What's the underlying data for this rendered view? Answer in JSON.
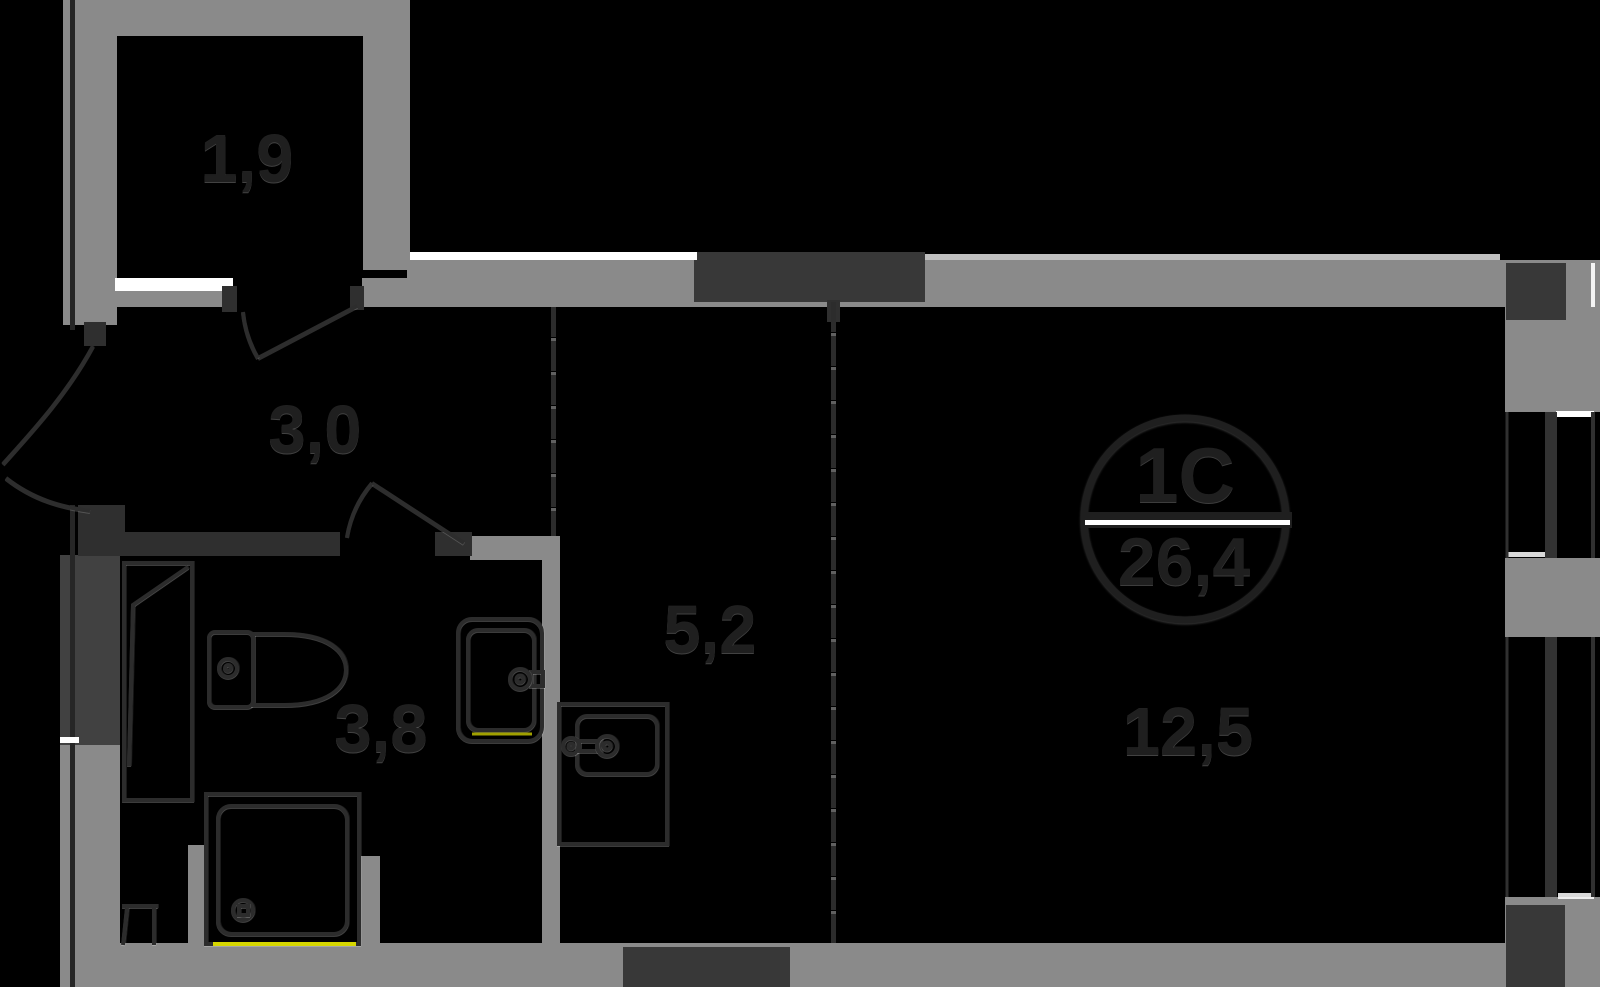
{
  "plan": {
    "unit": {
      "type_label": "1С",
      "area_label": "26,4"
    },
    "rooms": [
      {
        "id": "balcony",
        "area_label": "1,9"
      },
      {
        "id": "hallway",
        "area_label": "3,0"
      },
      {
        "id": "bathroom",
        "area_label": "3,8"
      },
      {
        "id": "kitchen",
        "area_label": "5,2"
      },
      {
        "id": "living-room",
        "area_label": "12,5"
      }
    ],
    "fixtures": [
      "closet",
      "toilet",
      "washbasin",
      "shower-tray",
      "kitchen-sink"
    ],
    "colors": {
      "background": "#000000",
      "wall": "#8a8a8a",
      "wall_dark": "#414141",
      "shaft": "#383838",
      "line": "#2c2c2c",
      "text": "#1f1f1f",
      "white": "#ffffff",
      "accent_yellow": "#d6d600"
    }
  }
}
